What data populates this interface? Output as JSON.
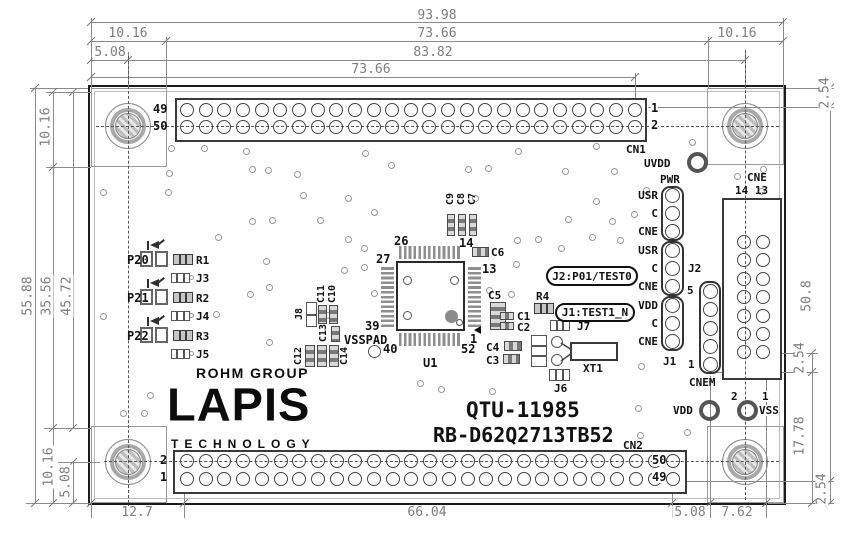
{
  "dims": {
    "overall_width": "93.98",
    "top_left_margin": "10.16",
    "top_span": "73.66",
    "top_right_margin": "10.16",
    "top_offset": "5.08",
    "hole_spacing": "83.82",
    "cn1_pin1_span": "73.66",
    "left_top": "10.16",
    "board_height": "55.88",
    "left_mid": "35.56",
    "left_span": "45.72",
    "left_bottom": "10.16",
    "left_bottom_offset": "5.08",
    "bottom_left": "12.7",
    "cn2_span": "66.04",
    "bottom_right_a": "5.08",
    "bottom_right_b": "7.62",
    "right_top": "2.54",
    "right_span": "50.8",
    "right_mid": "2.54",
    "right_lower": "17.78",
    "right_bottom": "2.54"
  },
  "logo": {
    "rohm": "ROHM GROUP",
    "lapis": "LAPIS",
    "tech": "TECHNOLOGY"
  },
  "title": {
    "line1": "QTU-11985",
    "line2": "RB-D62Q2713TB52"
  },
  "cn1": {
    "label": "CN1",
    "lt": "49",
    "lb": "50",
    "rt": "1",
    "rb": "2"
  },
  "cn2": {
    "label": "CN2",
    "lt": "2",
    "lb": "1",
    "rt": "50",
    "rb": "49"
  },
  "cne": {
    "label": "CNE",
    "cols": "14 13"
  },
  "pwr": {
    "label": "PWR",
    "pins": [
      "USR",
      "C",
      "CNE",
      "USR",
      "C",
      "CNE",
      "VDD",
      "C",
      "CNE"
    ],
    "j2": "J2",
    "j1": "J1"
  },
  "cnem": {
    "label": "CNEM",
    "top": "5",
    "bottom": "1"
  },
  "power": {
    "uvdd": "UVDD",
    "vdd": "VDD",
    "vdd_num": "2",
    "vss": "VSS",
    "vss_num": "1"
  },
  "chip": {
    "ref": "U1",
    "vsspad": "VSSPAD",
    "p26": "26",
    "p14": "14",
    "p27": "27",
    "p13": "13",
    "p39": "39",
    "p1": "1",
    "p40": "40",
    "p52": "52"
  },
  "callouts": {
    "j2": "J2:P01/TEST0",
    "j1": "J1:TEST1_N"
  },
  "leds": [
    {
      "port": "P20",
      "res": "R1",
      "jmp": "J3"
    },
    {
      "port": "P21",
      "res": "R2",
      "jmp": "J4"
    },
    {
      "port": "P22",
      "res": "R3",
      "jmp": "J5"
    }
  ],
  "parts": {
    "r4": "R4",
    "j6": "J6",
    "j7": "J7",
    "j8": "J8",
    "xt1": "XT1",
    "c1": "C1",
    "c2": "C2",
    "c3": "C3",
    "c4": "C4",
    "c5": "C5",
    "c6": "C6",
    "c7": "C7",
    "c8": "C8",
    "c9": "C9",
    "c10": "C10",
    "c11": "C11",
    "c12": "C12",
    "c13": "C13",
    "c14": "C14"
  }
}
